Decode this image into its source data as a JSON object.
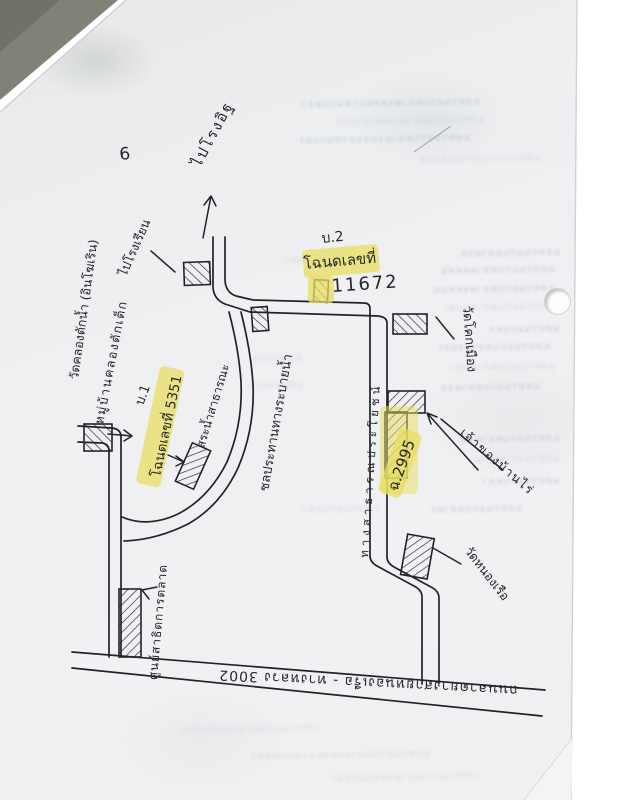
{
  "scan": {
    "page_number": "6",
    "ghost_glyphs": "มสทรนอกบดลวผจตสมอรทนกบดลวผจตมสทรนอกบดลว",
    "colors": {
      "ink": "#232428",
      "highlighter_yellow": "#e8de5f",
      "paper": "#eef0f2",
      "scanner_corner": "#7f8277"
    }
  },
  "map": {
    "direction_labels": {
      "kiln": "ไปโรงอิฐ",
      "school": "ไปโรงเรียน"
    },
    "deed_labels": {
      "b2": "บ.2",
      "deed1_title": "โฉนดเลขที่",
      "deed1_no": "11672",
      "b1": "บ.1",
      "deed2": "โฉนดเลขที่ 5351",
      "deed3": "ฉ.2995"
    },
    "place_labels": {
      "temple_left": "วัดคลองตักน้ำ (อินโฆเริน)",
      "village_left": "หมู่บ้านคลองตักเต็ก",
      "pond": "สระน้ำสาธารณะ",
      "canal": "ชลประทานทางระบายน้ำ",
      "public_way": "ทางสาธารณประโยชน์",
      "temple_right": "วัดโคกเมือง",
      "farm": "เจ้าของบ้านไร่",
      "temple_bottom": "วัดหนองเรือ",
      "market": "ศูนย์สาธิตการตลาด",
      "main_road": "ถนนลาดยางสายหนองเรือ - ทางหลวง 3002"
    }
  }
}
